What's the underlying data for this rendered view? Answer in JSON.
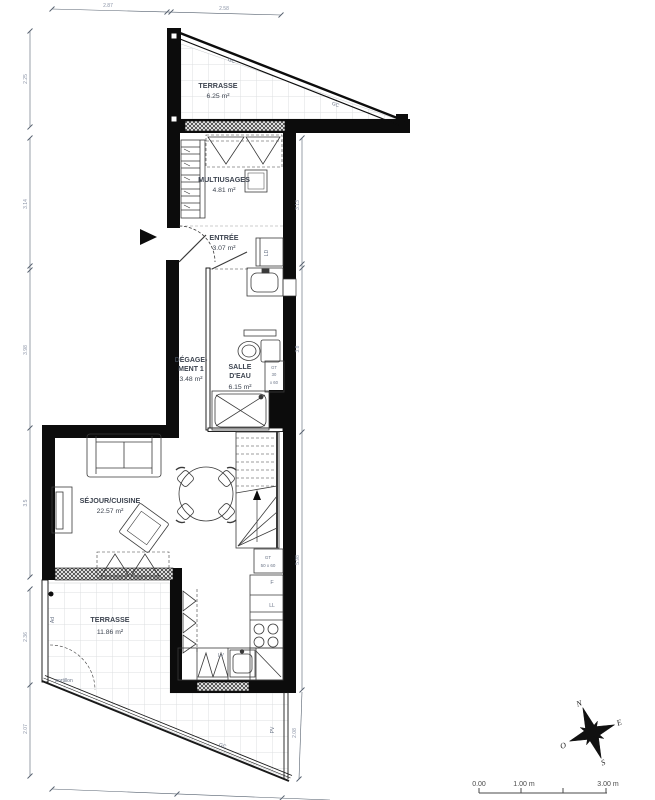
{
  "rooms": {
    "terrasse_haute": {
      "name": "TERRASSE",
      "area": "6.25 m²"
    },
    "multiusages": {
      "name": "MULTIUSAGES",
      "area": "4.81 m²"
    },
    "entree": {
      "name": "ENTRÉE",
      "area": "3.07 m²"
    },
    "degagement": {
      "name_line1": "DÉGAGE-",
      "name_line2": "MENT 1",
      "area": "3.48 m²"
    },
    "salle_deau": {
      "name_line1": "SALLE",
      "name_line2": "D'EAU",
      "area": "6.15 m²"
    },
    "sejour_cuisine": {
      "name": "SÉJOUR/CUISINE",
      "area": "22.57 m²"
    },
    "terrasse_basse": {
      "name": "TERRASSE",
      "area": "11.86 m²"
    }
  },
  "annotations": {
    "gc_terrasse_haute_1": "GC",
    "gc_terrasse_haute_2": "GC",
    "gc_terrasse_basse": "GC",
    "portillon": "portillon",
    "ad": "Ad",
    "pv": "PV",
    "ld": "LD",
    "fridge": "F",
    "lave_linge": "LL",
    "lave_vaisselle": "LV",
    "gt_salle_deau": {
      "line1": "GT",
      "line2": "30",
      "line3": "x 60"
    },
    "gt_cuisine": {
      "line1": "GT",
      "line2": "50 x 60"
    }
  },
  "dimensions": {
    "top": [
      "2.87",
      "2.58"
    ],
    "left": [
      "2.25",
      "3.14",
      "3.98",
      "3.5",
      "2.36",
      "2.07"
    ],
    "right": [
      "3.13",
      "3.8",
      "5.98",
      "2.08"
    ]
  },
  "scale_bar": {
    "tick_0": "0.00",
    "tick_1": "1.00 m",
    "tick_3": "3.00 m"
  },
  "compass": {
    "north": "N",
    "east": "E",
    "south": "S",
    "west": "O"
  },
  "colors": {
    "wall": "#0c0c0c",
    "dimension_text": "#8a93a6",
    "label_text": "#3d4450"
  }
}
